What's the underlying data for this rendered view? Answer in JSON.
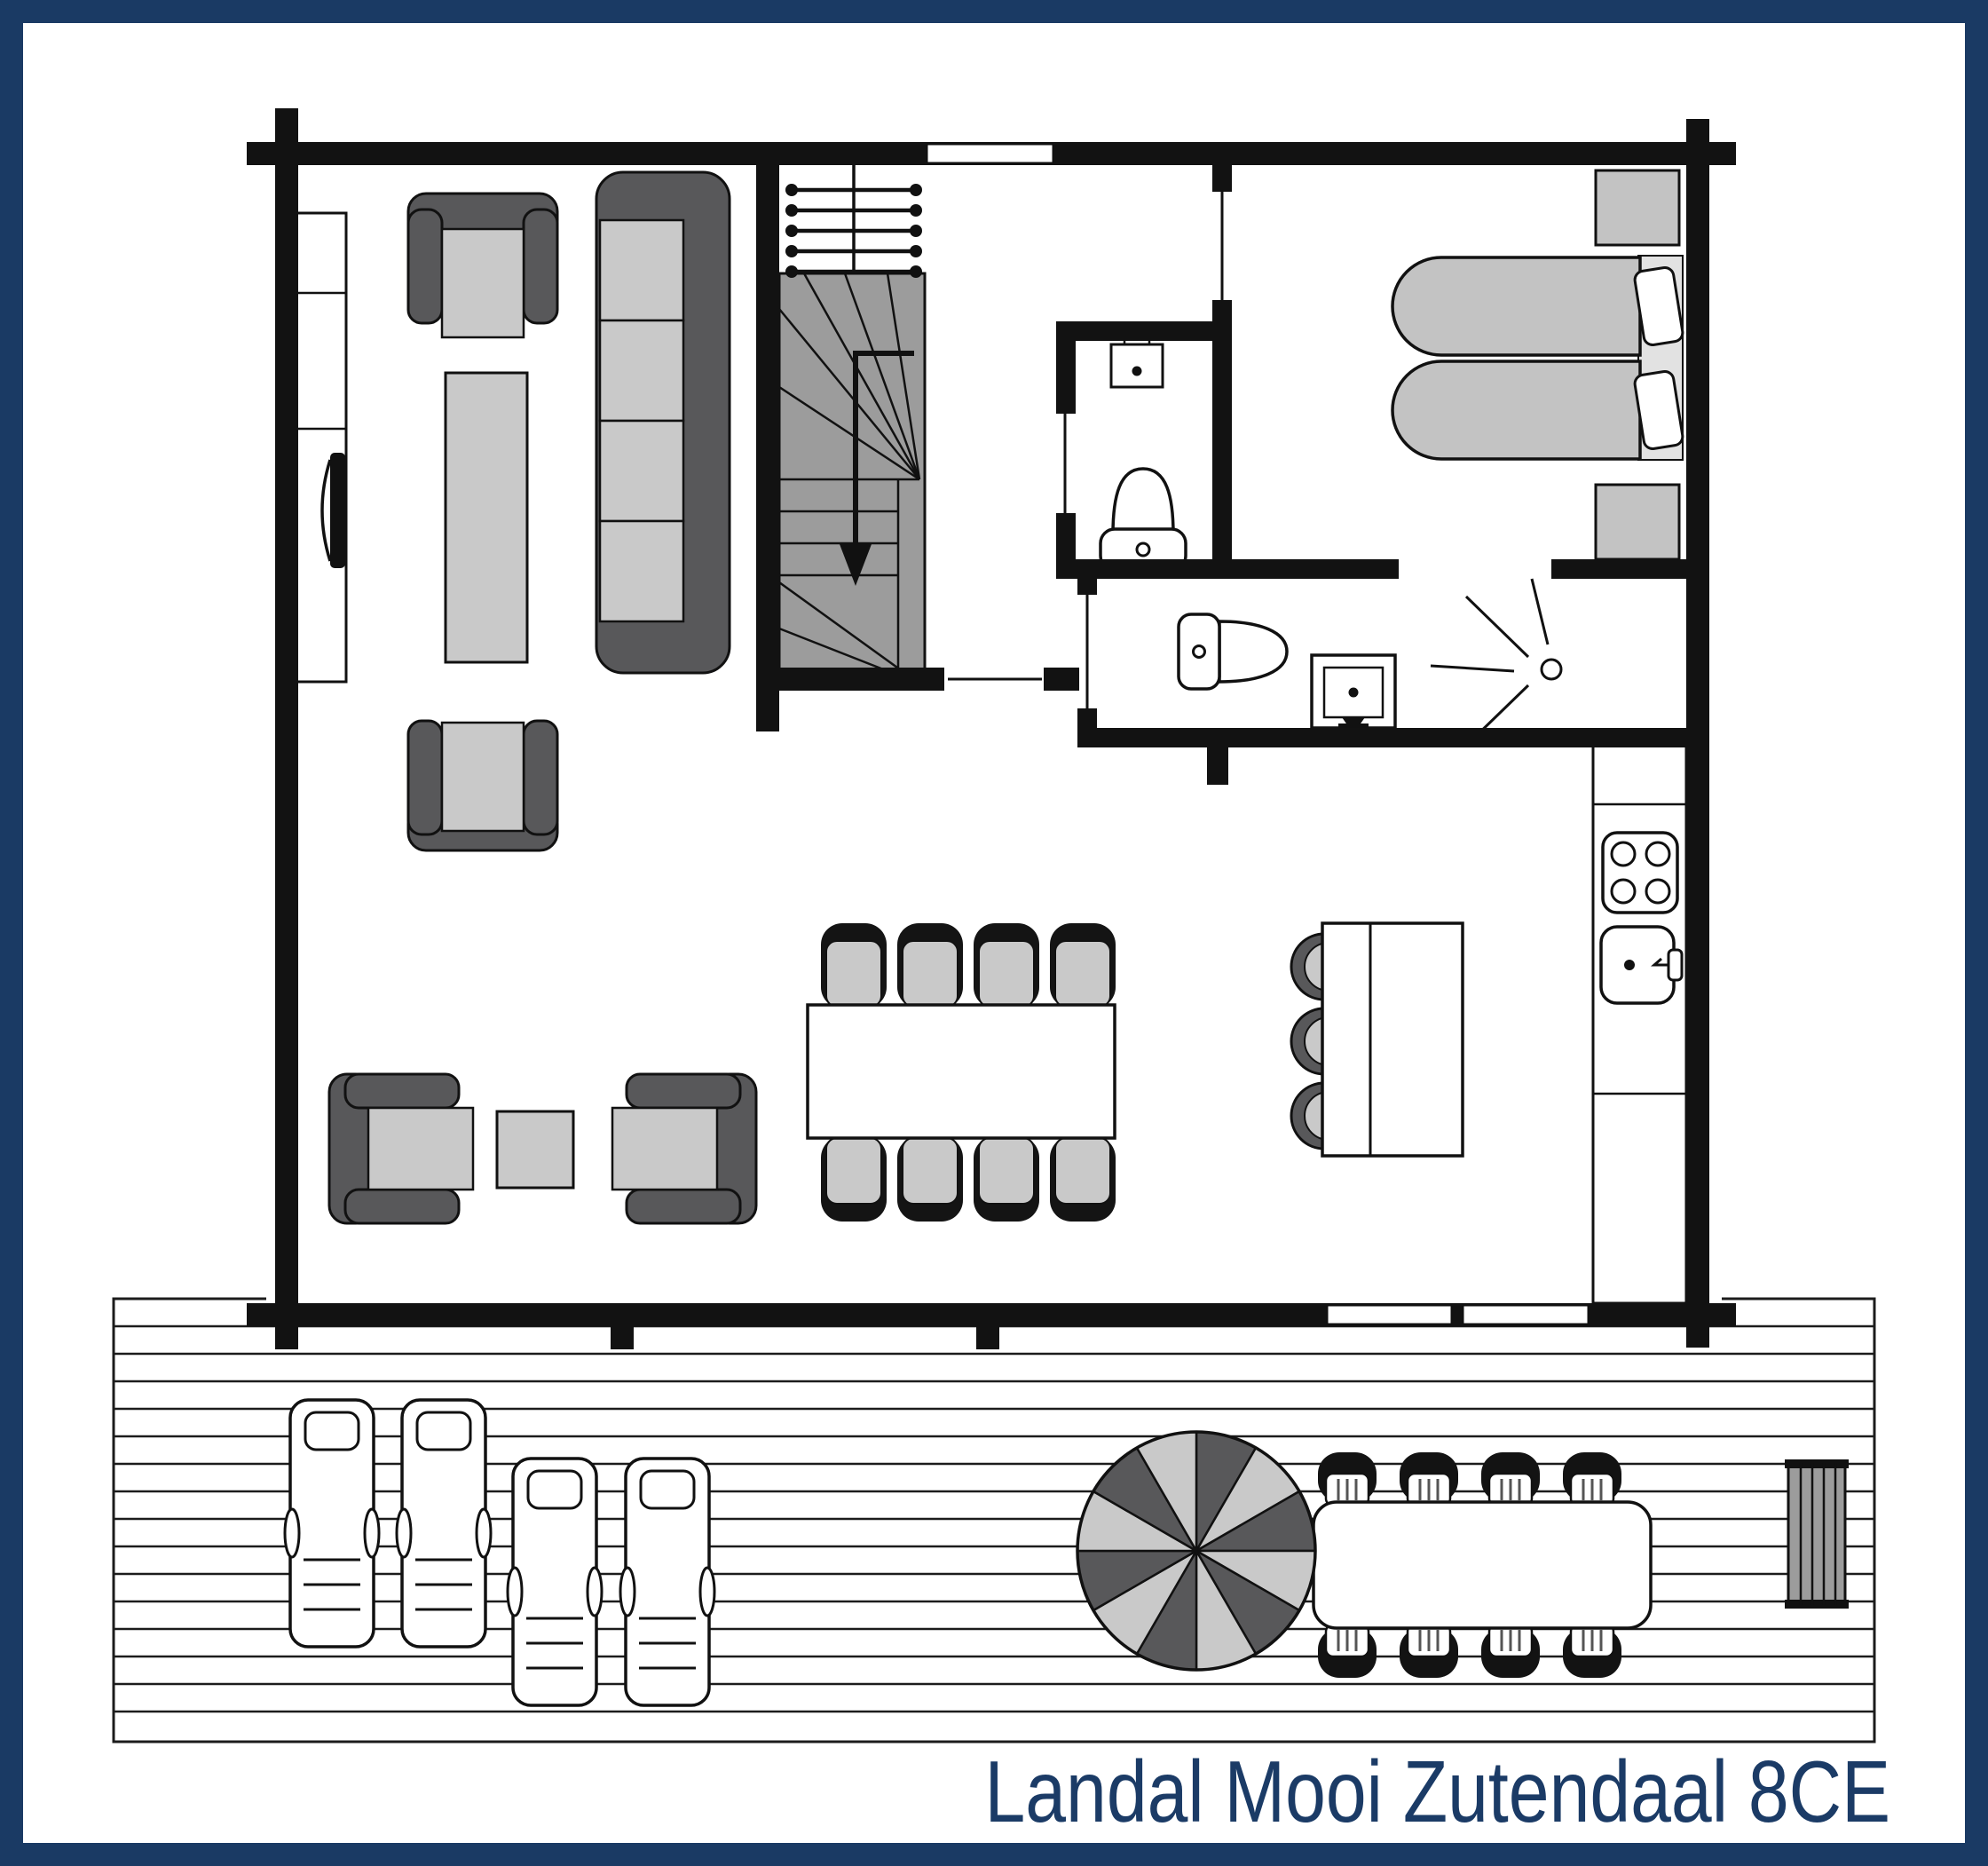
{
  "title": {
    "text": "Landal Mooi Zutendaal 8CE"
  },
  "theme": {
    "border_color": "#1a3a64",
    "title_color": "#1b3b66",
    "wall_color": "#121212",
    "line_color": "#1c1c1c",
    "stair_fill": "#9c9c9c",
    "furniture_dark": "#58585a",
    "furniture_light": "#c9c9c9",
    "duvet_gray": "#c3c3c3",
    "background": "#ffffff"
  },
  "floor_plan": {
    "floor": "ground floor",
    "rooms": [
      {
        "name": "living-room",
        "furniture": [
          "tv-cabinet",
          "tv",
          "armchair",
          "coffee-table",
          "sofa-four-seats",
          "armchair",
          "armchair",
          "side-table",
          "armchair"
        ]
      },
      {
        "name": "entrance-hall",
        "furniture": [
          "staircase-down",
          "stair-railing",
          "window"
        ]
      },
      {
        "name": "wc",
        "furniture": [
          "hand-basin",
          "toilet"
        ]
      },
      {
        "name": "bathroom",
        "furniture": [
          "toilet",
          "washbasin",
          "shower"
        ]
      },
      {
        "name": "bedroom",
        "furniture": [
          "nightstand",
          "single-bed",
          "single-bed",
          "pillow",
          "pillow",
          "nightstand"
        ]
      },
      {
        "name": "kitchen",
        "furniture": [
          "kitchen-counter",
          "hob-four-burners",
          "sink-with-tap"
        ]
      },
      {
        "name": "dining-area",
        "furniture": [
          "dining-table",
          "chair",
          "chair",
          "chair",
          "chair",
          "chair",
          "chair",
          "chair",
          "chair",
          "bar-table",
          "stool",
          "stool",
          "stool"
        ]
      },
      {
        "name": "terrace",
        "furniture": [
          "wooden-deck",
          "sun-lounger",
          "sun-lounger",
          "sun-lounger",
          "sun-lounger",
          "parasol",
          "outdoor-dining-table",
          "outdoor-chair",
          "outdoor-chair",
          "outdoor-chair",
          "outdoor-chair",
          "outdoor-chair",
          "outdoor-chair",
          "outdoor-chair",
          "outdoor-chair",
          "planter-bench"
        ]
      }
    ],
    "counts": {
      "indoor_dining_seats": 8,
      "outdoor_dining_seats": 8,
      "bar_stools": 3,
      "sun_loungers": 4,
      "beds": 2,
      "parasol_segments": 12
    }
  }
}
